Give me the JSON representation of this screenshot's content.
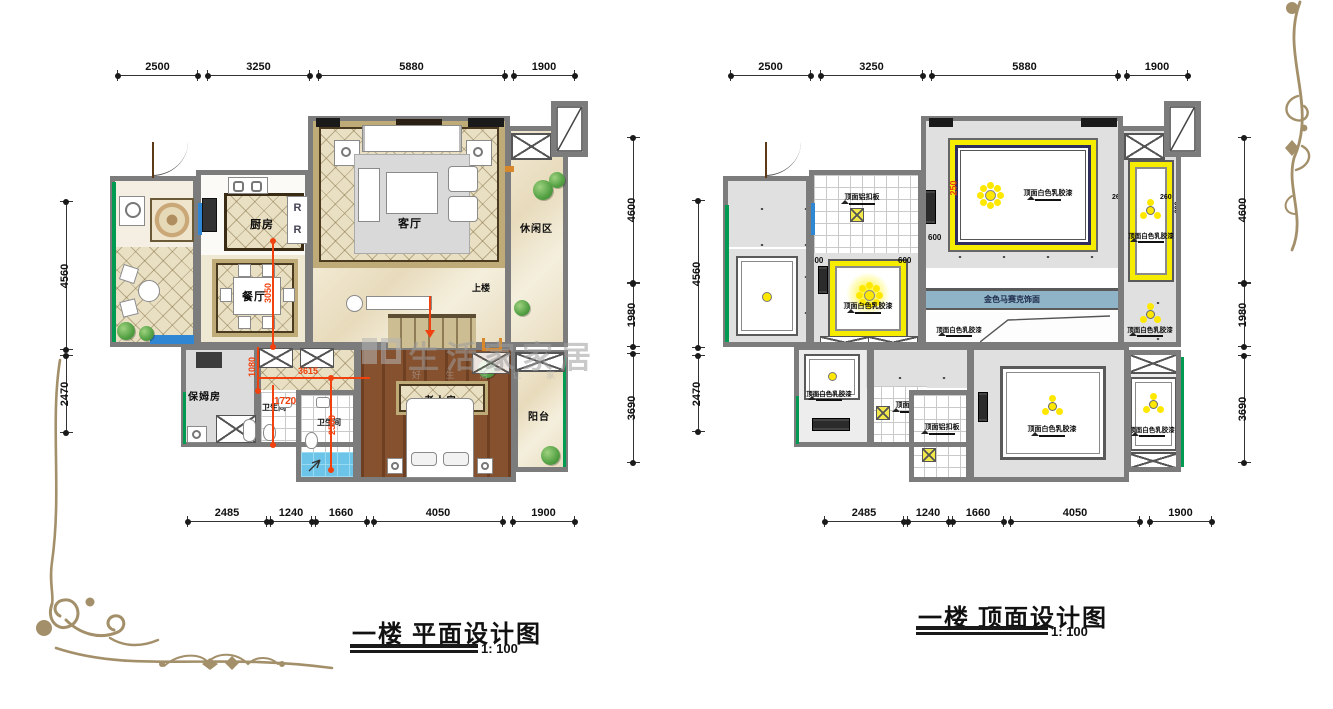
{
  "watermark": {
    "brand": "生活家家居",
    "slogan": "好 生 活  让 家"
  },
  "plans": {
    "floor": {
      "title": "一楼 平面设计图",
      "scale_label": "1: 100",
      "dims": {
        "top": [
          "2500",
          "3250",
          "5880",
          "1900"
        ],
        "bottom": [
          "2485",
          "1240",
          "1660",
          "4050",
          "1900"
        ],
        "left": [
          "4560",
          "2470"
        ],
        "right": [
          "4600",
          "1980",
          "3690"
        ]
      },
      "rooms": {
        "kitchen": "厨房",
        "dining": "餐厅",
        "living": "客厅",
        "leisure": "休闲区",
        "nanny": "保姆房",
        "bath1": "卫生间",
        "bath2": "卫生间",
        "elder": "老人房",
        "balcony": "阳台",
        "stairs": "上楼"
      },
      "red_dims": [
        "3050",
        "1080",
        "3615",
        "1720",
        "2500"
      ],
      "fridge_mark": "R"
    },
    "ceiling": {
      "title": "一楼 顶面设计图",
      "scale_label": "1: 100",
      "dims": {
        "top": [
          "2500",
          "3250",
          "5880",
          "1900"
        ],
        "bottom": [
          "2485",
          "1240",
          "1660",
          "4050",
          "1900"
        ],
        "left": [
          "4560",
          "2470"
        ],
        "right": [
          "4600",
          "1980",
          "3690"
        ]
      },
      "labels": {
        "alum_panel": "顶面铝扣板",
        "white_paint": "顶面白色乳胶漆",
        "gold_mosaic": "金色马赛克饰面"
      },
      "small_dims": {
        "d600": "600",
        "d250": "250",
        "d260": "260",
        "d300": "300"
      }
    }
  },
  "colors": {
    "flourish_gold": "#a3906a",
    "wall_gray": "#7c7c7c",
    "accent_yellow": "#ffe800",
    "mosaic_blue": "#8fb3c7"
  }
}
